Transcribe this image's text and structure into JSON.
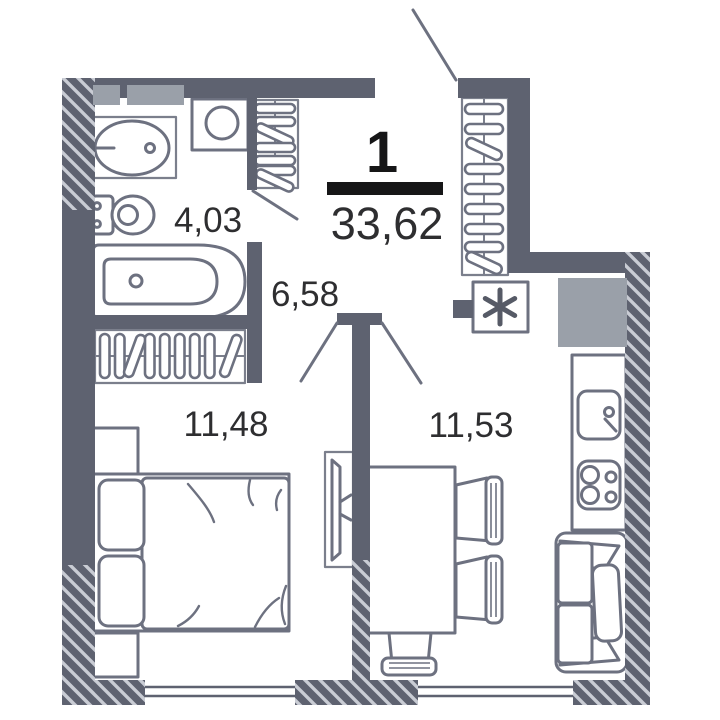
{
  "title": {
    "apartment_number": "1",
    "total_area": "33,62"
  },
  "rooms": {
    "bathroom": {
      "name": "bathroom",
      "area": "4,03"
    },
    "hallway": {
      "name": "hallway",
      "area": "6,58"
    },
    "bedroom": {
      "name": "bedroom",
      "area": "11,48"
    },
    "kitchen_living": {
      "name": "kitchen-living",
      "area": "11,53"
    }
  },
  "colors": {
    "wall": "#5e6270",
    "hatch_line": "#c9ccd4",
    "furniture_stroke": "#6d7180",
    "light_fill": "#9aa0a9",
    "title_text": "#161617",
    "label_text": "#2e2e30",
    "background": "#ffffff"
  },
  "icons": [
    "sink-icon",
    "toilet-icon",
    "bathtub-icon",
    "washing-machine-icon",
    "wardrobe-hangers-icon",
    "bed-icon",
    "pillow-icon",
    "nightstand-icon",
    "tv-icon",
    "dining-table-icon",
    "chair-icon",
    "kitchen-counter-icon",
    "kitchen-sink-icon",
    "stove-icon",
    "sofa-icon",
    "fridge-asterisk-icon",
    "vent-shaft-icon",
    "window-icon",
    "door-swing-icon",
    "wall-hatch-icon"
  ]
}
